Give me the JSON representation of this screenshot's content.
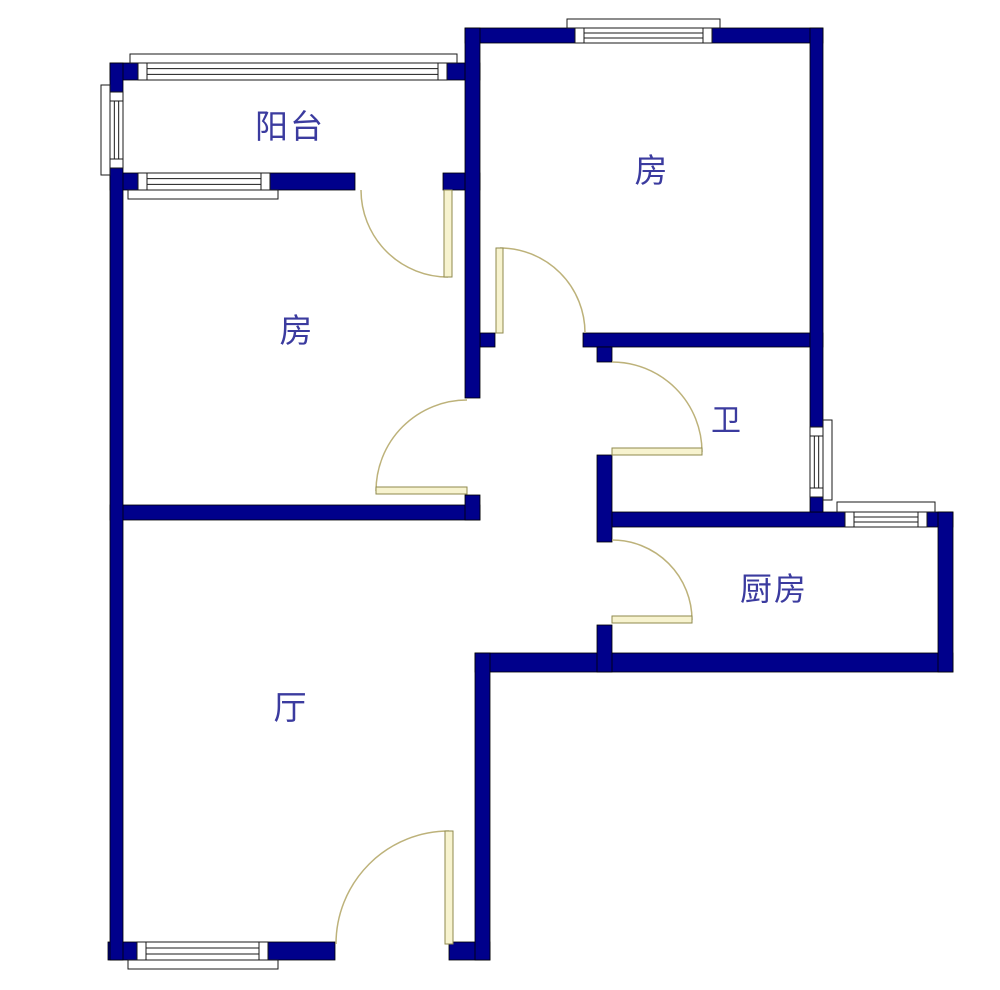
{
  "floorplan": {
    "type": "apartment-floor-plan",
    "rooms": [
      {
        "id": "balcony",
        "label": "阳台"
      },
      {
        "id": "bedroom-left",
        "label": "房"
      },
      {
        "id": "bedroom-topright",
        "label": "房"
      },
      {
        "id": "bathroom",
        "label": "卫"
      },
      {
        "id": "kitchen",
        "label": "厨房"
      },
      {
        "id": "living-room",
        "label": "厅"
      }
    ],
    "colors": {
      "wall": "#00008B",
      "wall_outline": "#000000",
      "window_fill": "#FFFFFF",
      "window_outline": "#1a1a1a",
      "door_leaf_fill": "#F7F3CF",
      "door_leaf_border": "#8F8A4E",
      "door_arc": "#BDB27A",
      "label_text": "#3B3B9F",
      "background": "#FFFFFF"
    }
  }
}
